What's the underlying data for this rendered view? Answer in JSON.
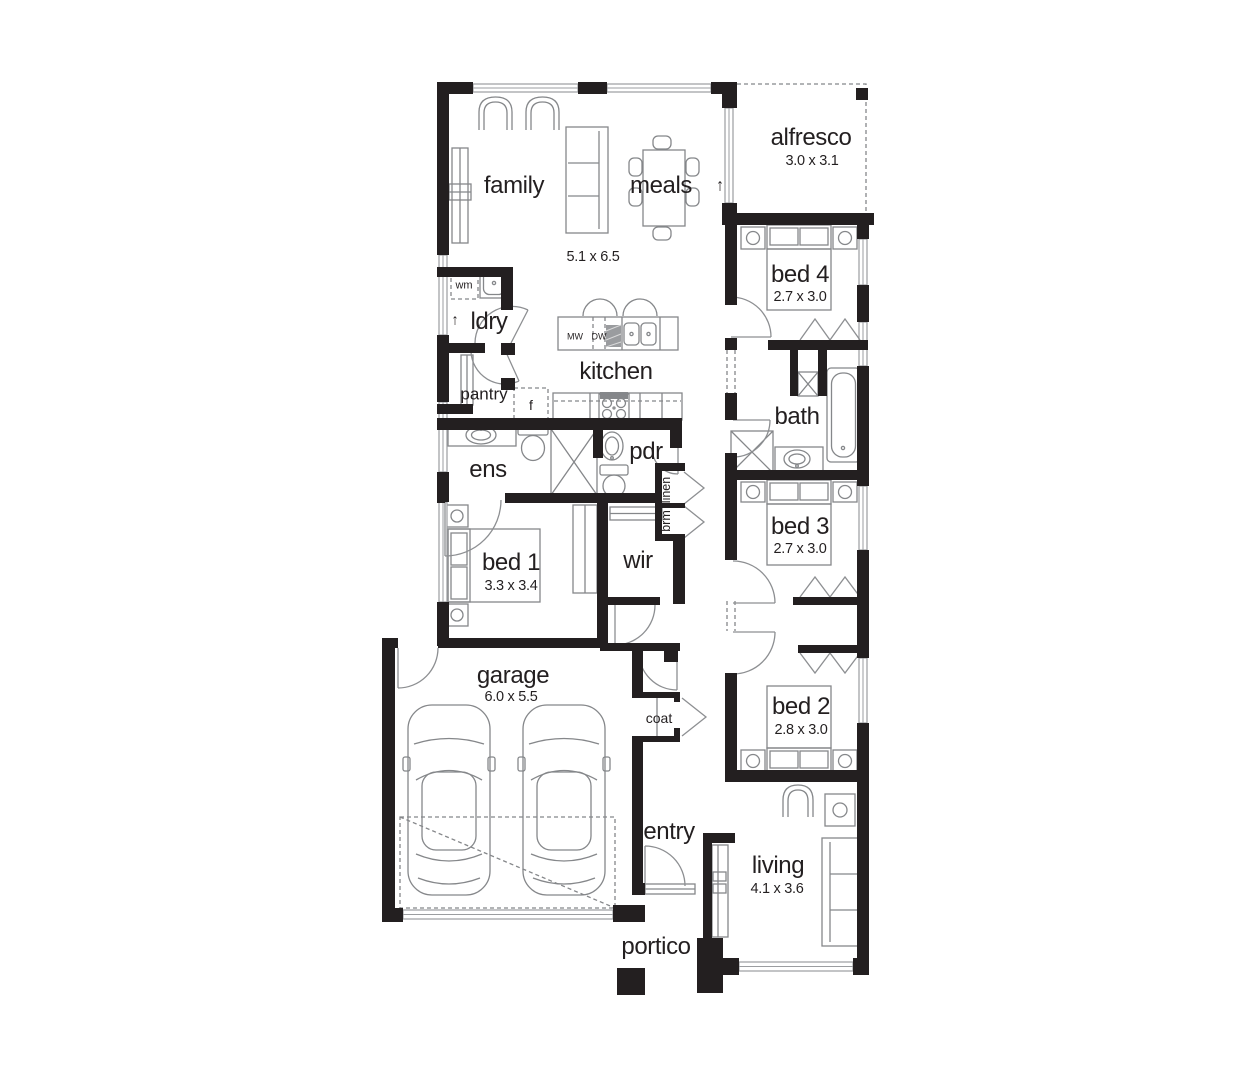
{
  "title": "single-storey house floor plan",
  "colors": {
    "background": "#ffffff",
    "wall": "#231f20",
    "fixture_line": "#85878a",
    "window_line": "#9b9da0",
    "text": "#231f20"
  },
  "labels": {
    "family": "family",
    "meals": "meals",
    "family_meals_size": "5.1 x 6.5",
    "alfresco": "alfresco",
    "alfresco_size": "3.0 x 3.1",
    "laundry": "ldry",
    "washing_machine": "wm",
    "pantry": "pantry",
    "fridge": "f",
    "kitchen": "kitchen",
    "microwave": "MW",
    "dishwasher": "DW",
    "bed4": "bed 4",
    "bed4_size": "2.7 x 3.0",
    "bath": "bath",
    "ensuite": "ens",
    "powder": "pdr",
    "linen": "linen",
    "broom": "brm",
    "bed3": "bed 3",
    "bed3_size": "2.7 x 3.0",
    "bed1": "bed 1",
    "bed1_size": "3.3 x 3.4",
    "wir": "wir",
    "garage": "garage",
    "garage_size": "6.0 x 5.5",
    "coat": "coat",
    "bed2": "bed 2",
    "bed2_size": "2.8 x 3.0",
    "entry": "entry",
    "living": "living",
    "living_size": "4.1 x 3.6",
    "portico": "portico",
    "arrow_up": "↑"
  }
}
